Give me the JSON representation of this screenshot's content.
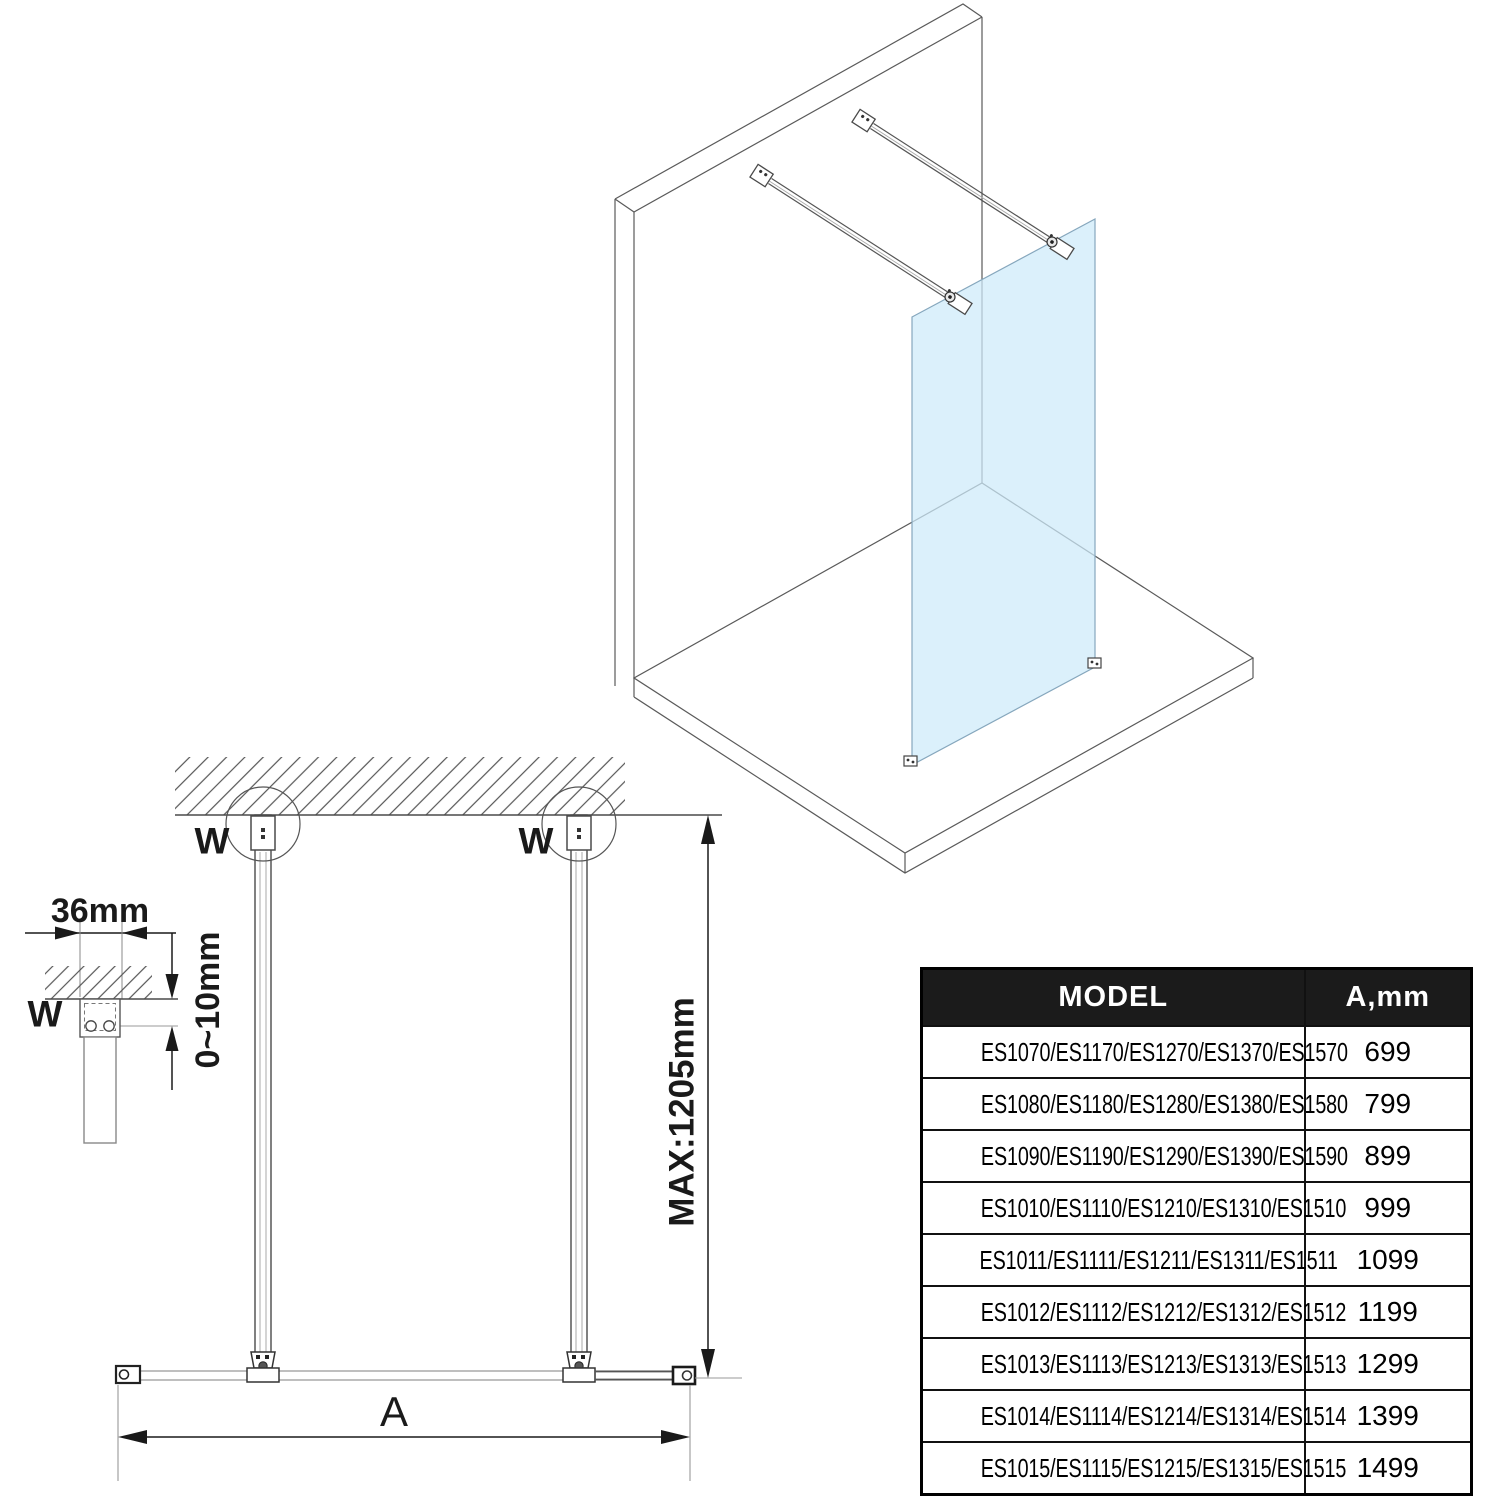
{
  "labels": {
    "bracket_width": "36mm",
    "ceiling_gap": "0~10mm",
    "wall_marker": "W",
    "max_height": "MAX:1205mm",
    "glass_width": "A"
  },
  "table": {
    "headers": {
      "model": "MODEL",
      "a": "A,mm"
    },
    "rows": [
      {
        "model": "ES1070/ES1170/ES1270/ES1370/ES1570",
        "a": "699"
      },
      {
        "model": "ES1080/ES1180/ES1280/ES1380/ES1580",
        "a": "799"
      },
      {
        "model": "ES1090/ES1190/ES1290/ES1390/ES1590",
        "a": "899"
      },
      {
        "model": "ES1010/ES1110/ES1210/ES1310/ES1510",
        "a": "999"
      },
      {
        "model": "ES1011/ES1111/ES1211/ES1311/ES1511",
        "a": "1099"
      },
      {
        "model": "ES1012/ES1112/ES1212/ES1312/ES1512",
        "a": "1199"
      },
      {
        "model": "ES1013/ES1113/ES1213/ES1313/ES1513",
        "a": "1299"
      },
      {
        "model": "ES1014/ES1114/ES1214/ES1314/ES1514",
        "a": "1399"
      },
      {
        "model": "ES1015/ES1115/ES1215/ES1315/ES1515",
        "a": "1499"
      }
    ]
  },
  "colors": {
    "glass_fill": "#cdeaf9",
    "glass_edge": "#86a7bd",
    "line": "#4a4a4a",
    "dim": "#1a1a1a",
    "table_header_bg": "#1b1b1b",
    "table_header_text": "#ffffff"
  }
}
